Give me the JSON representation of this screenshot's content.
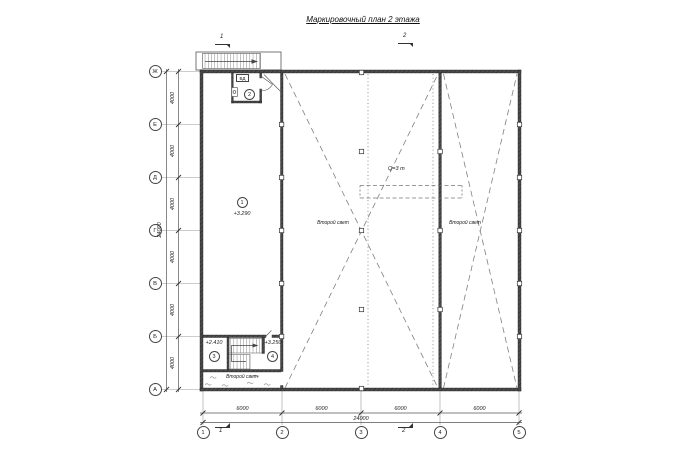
{
  "title": "Маркировочный план 2 этажа",
  "section_marks": {
    "top1": "1",
    "top2": "2",
    "bottom1": "1",
    "bottom2": "2"
  },
  "grid": {
    "row_labels": [
      "Ж",
      "Е",
      "Д",
      "Г",
      "В",
      "Б",
      "А"
    ],
    "col_labels": [
      "1",
      "2",
      "3",
      "4",
      "5"
    ],
    "row_spacings": [
      "4000",
      "4000",
      "4000",
      "4000",
      "4000",
      "4000"
    ],
    "row_total": "24000",
    "col_spacings": [
      "6000",
      "6000",
      "6000",
      "6000"
    ],
    "col_total": "24000"
  },
  "rooms": {
    "r1": {
      "num": "1",
      "elev": "+3.290"
    },
    "r2": {
      "num": "2"
    },
    "r3": {
      "num": "3",
      "elev": "+2.410"
    },
    "r4": {
      "num": "4",
      "elev": "+3.250"
    }
  },
  "annotations": {
    "crane_capacity": "Q=3 т",
    "second_light_hall_left": "Второй свет",
    "second_light_hall_right": "Второй свет",
    "second_light_bottom": "Второй свет",
    "vent_box": "ВД"
  }
}
